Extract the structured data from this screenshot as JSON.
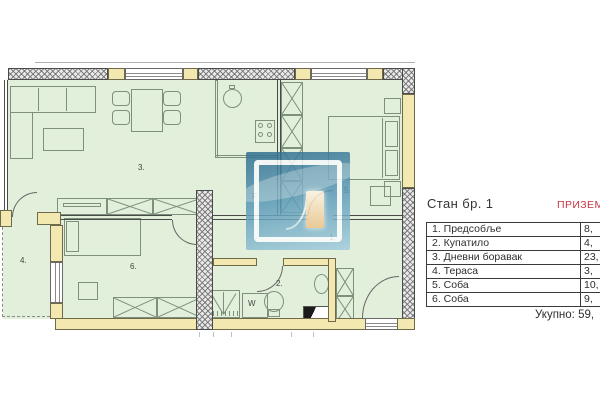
{
  "panel": {
    "title": "Стан бр. 1",
    "floor_label": "ПРИЗЕМЉЕ",
    "rows": [
      {
        "name": "1. Предсобље",
        "area": "8,"
      },
      {
        "name": "2. Купатило",
        "area": "4,"
      },
      {
        "name": "3. Дневни боравак",
        "area": "23,"
      },
      {
        "name": "4. Тераса",
        "area": "3,"
      },
      {
        "name": "5. Соба",
        "area": "10,"
      },
      {
        "name": "6. Соба",
        "area": "9,"
      }
    ],
    "total": "Укупно: 59,"
  },
  "floorplan": {
    "room_labels": [
      {
        "text": "1.",
        "x": 329,
        "y": 233
      },
      {
        "text": "2.",
        "x": 276,
        "y": 279
      },
      {
        "text": "3.",
        "x": 138,
        "y": 163
      },
      {
        "text": "4.",
        "x": 20,
        "y": 256
      },
      {
        "text": "5.",
        "x": 344,
        "y": 186
      },
      {
        "text": "6.",
        "x": 130,
        "y": 262
      }
    ],
    "fixture_labels": [
      {
        "text": "W",
        "x": 248,
        "y": 299
      },
      {
        "text": "F",
        "x": 252,
        "y": 192
      }
    ]
  },
  "colors": {
    "accent_red": "#c63440",
    "room_fill": "#e2efda",
    "wall_fill": "#f2e8b0",
    "line_green": "#7c907c",
    "wm_dark": "#2d6d8e",
    "wm_light": "#a3cddd"
  }
}
